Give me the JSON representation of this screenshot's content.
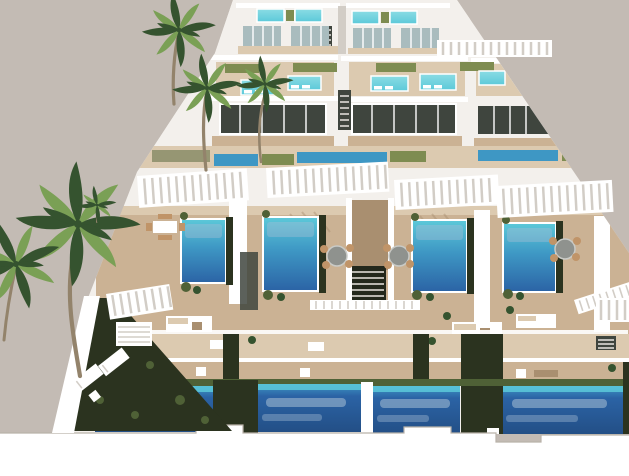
{
  "scene": {
    "title": "Aerial 3D architectural rendering of a terraced development of modern white villas with private pools, wooden sun decks, white pergolas and palm trees on a warm grey backdrop",
    "type": "3d-architectural-render",
    "view": "high aerial oblique view, development steps down toward the viewer",
    "rows": [
      {
        "id": "row-a",
        "label": "back row duplex villas with small rooftop plunge pools",
        "rooftop_pools": 4
      },
      {
        "id": "row-b",
        "label": "upper row duplex villas with rooftop pools, in-pool loungers and lawn strips",
        "rooftop_pools": 5,
        "lap_pools": 3
      },
      {
        "id": "pergola-band",
        "label": "white slatted pergolas over the entrance terraces",
        "pergolas": 7
      },
      {
        "id": "row-c",
        "label": "middle row villas, each with a private rectangular pool, hedge planters, round dining set and lounge sofas",
        "pools": 4,
        "dining_sets": 4,
        "sofa_sets": 3
      },
      {
        "id": "row-d",
        "label": "lower terrace decks with outdoor lounge furniture and railings",
        "deck_levels": 2
      },
      {
        "id": "row-e",
        "label": "front row of large ground-level swimming pools separated by hedge corridors",
        "pools": 4
      },
      {
        "id": "perimeter-wall",
        "label": "stepped white perimeter wall along the bottom edge"
      }
    ],
    "vegetation": {
      "palm_trees": 5,
      "hedge_garden": "dark green hedge garden strip along the left boundary",
      "planters": "green shrubs bordering every pool"
    },
    "props": {
      "sun_loungers_on_lawn": 2
    },
    "palette": {
      "bg": "#c3bbb4",
      "white": "#f3f0ec",
      "white_bright": "#ffffff",
      "white_shade": "#e9e5e0",
      "white_shadow": "#d2cdc6",
      "deck": "#cbb294",
      "deck_light": "#dccab0",
      "deck_shadow": "#a98f70",
      "chair": "#c09468",
      "glass": "#3f453e",
      "glass_light": "#a9bcbe",
      "lawn": "#7e8c51",
      "lawn_dark": "#4f6136",
      "hedge": "#2b331f",
      "rooftop_pool": "#8adce4",
      "pool_top": "#5cc9d9",
      "pool_mid": "#3e97c4",
      "pool_deep": "#2b63a5",
      "pool_streak": "#a7bfd4",
      "palm_dark": "#35532f",
      "palm_light": "#7aa055",
      "trunk": "#93836b",
      "wall_shadow": "#b9b2a9"
    }
  }
}
